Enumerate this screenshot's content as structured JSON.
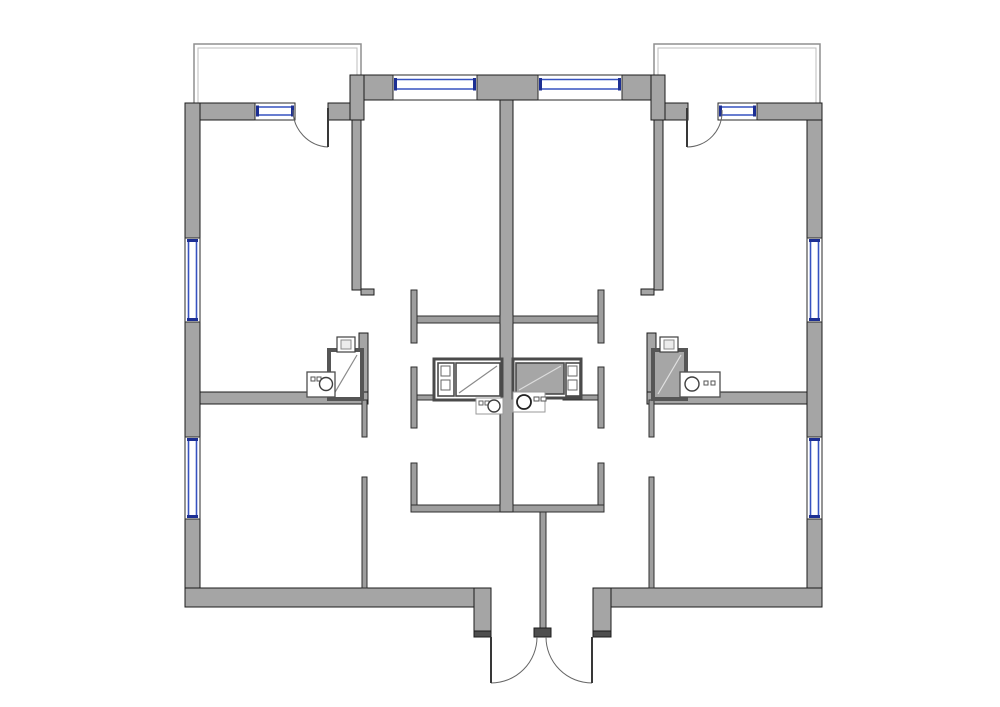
{
  "floorplan": {
    "canvas": {
      "width": 1000,
      "height": 707
    },
    "colors": {
      "bg": "#ffffff",
      "wall": "#a5a5a5",
      "thin": "#9e9e9e",
      "dark": "#4e4e4e",
      "outline": "#1c1c1c",
      "thin_outline": "#2f2f2f",
      "window_blue": "#3752c0",
      "window_navy": "#1d2f93",
      "window_frame": "#2a2a2a",
      "door_arc": "#666666",
      "door_leaf": "#383838",
      "balcony_outer": "#8f8f8f",
      "balcony_inner": "#bdbdbd"
    },
    "walls": [
      {
        "name": "exterior-wall-left-upper",
        "type": "wall",
        "x": 185,
        "y": 103,
        "w": 15,
        "h": 135
      },
      {
        "name": "exterior-wall-left-middle",
        "type": "wall",
        "x": 185,
        "y": 322,
        "w": 15,
        "h": 115
      },
      {
        "name": "exterior-wall-left-lower",
        "type": "wall",
        "x": 185,
        "y": 519,
        "w": 15,
        "h": 88
      },
      {
        "name": "exterior-wall-topleft-a",
        "type": "wall",
        "x": 200,
        "y": 103,
        "w": 55,
        "h": 17
      },
      {
        "name": "exterior-wall-topleft-b",
        "type": "wall",
        "x": 328,
        "y": 103,
        "w": 22,
        "h": 17
      },
      {
        "name": "exterior-wall-step-left",
        "type": "wall",
        "x": 350,
        "y": 75,
        "w": 14,
        "h": 45
      },
      {
        "name": "exterior-wall-pier-left",
        "type": "wall",
        "x": 364,
        "y": 75,
        "w": 29,
        "h": 25
      },
      {
        "name": "exterior-wall-pier-center",
        "type": "wall",
        "x": 477,
        "y": 75,
        "w": 61,
        "h": 25
      },
      {
        "name": "exterior-wall-pier-right",
        "type": "wall",
        "x": 622,
        "y": 75,
        "w": 29,
        "h": 25
      },
      {
        "name": "exterior-wall-step-right",
        "type": "wall",
        "x": 651,
        "y": 75,
        "w": 14,
        "h": 45
      },
      {
        "name": "exterior-wall-topright-a",
        "type": "wall",
        "x": 665,
        "y": 103,
        "w": 23,
        "h": 17
      },
      {
        "name": "exterior-wall-topright-b",
        "type": "wall",
        "x": 757,
        "y": 103,
        "w": 65,
        "h": 17
      },
      {
        "name": "exterior-wall-right-upper",
        "type": "wall",
        "x": 807,
        "y": 120,
        "w": 15,
        "h": 118
      },
      {
        "name": "exterior-wall-right-middle",
        "type": "wall",
        "x": 807,
        "y": 322,
        "w": 15,
        "h": 115
      },
      {
        "name": "exterior-wall-right-lower",
        "type": "wall",
        "x": 807,
        "y": 519,
        "w": 15,
        "h": 88
      },
      {
        "name": "exterior-wall-bottom-left",
        "type": "wall",
        "x": 185,
        "y": 588,
        "w": 289,
        "h": 19
      },
      {
        "name": "entry-jamb-left",
        "type": "wall",
        "x": 474,
        "y": 588,
        "w": 17,
        "h": 43
      },
      {
        "name": "exterior-wall-bottom-right",
        "type": "wall",
        "x": 611,
        "y": 588,
        "w": 211,
        "h": 19
      },
      {
        "name": "entry-jamb-right",
        "type": "wall",
        "x": 593,
        "y": 588,
        "w": 18,
        "h": 43
      },
      {
        "name": "party-wall-center",
        "type": "wall",
        "x": 500,
        "y": 100,
        "w": 13,
        "h": 412
      },
      {
        "name": "entry-divider-wall",
        "type": "thin",
        "x": 540,
        "y": 512,
        "w": 6,
        "h": 116
      },
      {
        "name": "bedroom-wall-left",
        "type": "wall",
        "x": 352,
        "y": 120,
        "w": 9,
        "h": 170
      },
      {
        "name": "bedroom-wall-left-foot",
        "type": "wall",
        "x": 361,
        "y": 289,
        "w": 13,
        "h": 6
      },
      {
        "name": "bedroom-wall-right",
        "type": "wall",
        "x": 654,
        "y": 120,
        "w": 9,
        "h": 170
      },
      {
        "name": "bedroom-wall-right-foot",
        "type": "wall",
        "x": 641,
        "y": 289,
        "w": 13,
        "h": 6
      },
      {
        "name": "room-divider-left",
        "type": "wall",
        "x": 200,
        "y": 392,
        "w": 168,
        "h": 12
      },
      {
        "name": "room-divider-right",
        "type": "wall",
        "x": 647,
        "y": 392,
        "w": 160,
        "h": 12
      },
      {
        "name": "bath-wall-left",
        "type": "wall",
        "x": 359,
        "y": 333,
        "w": 9,
        "h": 59
      },
      {
        "name": "bath-wall-right",
        "type": "wall",
        "x": 647,
        "y": 333,
        "w": 9,
        "h": 59
      },
      {
        "name": "kitchen-wall-left-cap",
        "type": "thin",
        "x": 411,
        "y": 290,
        "w": 6,
        "h": 53
      },
      {
        "name": "kitchen-wall-left-top",
        "type": "thin",
        "x": 417,
        "y": 316,
        "w": 83,
        "h": 7
      },
      {
        "name": "kitchen-wall-right-cap",
        "type": "thin",
        "x": 598,
        "y": 290,
        "w": 6,
        "h": 53
      },
      {
        "name": "kitchen-wall-right-top",
        "type": "thin",
        "x": 513,
        "y": 316,
        "w": 85,
        "h": 7
      },
      {
        "name": "kitchen-wall-left-mid",
        "type": "thin",
        "x": 411,
        "y": 367,
        "w": 6,
        "h": 61
      },
      {
        "name": "kitchen-wall-right-mid",
        "type": "thin",
        "x": 598,
        "y": 367,
        "w": 6,
        "h": 61
      },
      {
        "name": "kitchen-wall-left-low",
        "type": "thin",
        "x": 411,
        "y": 463,
        "w": 6,
        "h": 49
      },
      {
        "name": "kitchen-wall-left-bottom",
        "type": "thin",
        "x": 411,
        "y": 505,
        "w": 89,
        "h": 7
      },
      {
        "name": "kitchen-wall-right-low",
        "type": "thin",
        "x": 598,
        "y": 463,
        "w": 6,
        "h": 49
      },
      {
        "name": "kitchen-wall-right-bottom",
        "type": "thin",
        "x": 513,
        "y": 505,
        "w": 91,
        "h": 7
      },
      {
        "name": "hall-wall-left-upper",
        "type": "thin",
        "x": 362,
        "y": 400,
        "w": 5,
        "h": 37
      },
      {
        "name": "hall-wall-right-upper",
        "type": "thin",
        "x": 649,
        "y": 400,
        "w": 5,
        "h": 37
      },
      {
        "name": "hall-wall-left-lower",
        "type": "thin",
        "x": 362,
        "y": 477,
        "w": 5,
        "h": 111
      },
      {
        "name": "hall-wall-right-lower",
        "type": "thin",
        "x": 649,
        "y": 477,
        "w": 5,
        "h": 111
      },
      {
        "name": "appliance-wall-left",
        "type": "thin",
        "x": 417,
        "y": 395,
        "w": 35,
        "h": 5
      },
      {
        "name": "appliance-wall-right",
        "type": "thin",
        "x": 563,
        "y": 395,
        "w": 35,
        "h": 5
      },
      {
        "name": "entry-jamb-cap-left",
        "type": "dark",
        "x": 474,
        "y": 631,
        "w": 17,
        "h": 6
      },
      {
        "name": "entry-jamb-cap-right",
        "type": "dark",
        "x": 593,
        "y": 631,
        "w": 18,
        "h": 6
      },
      {
        "name": "entry-center-cap",
        "type": "dark",
        "x": 534,
        "y": 628,
        "w": 17,
        "h": 9
      }
    ],
    "windows": [
      {
        "name": "window-left-upper",
        "dir": "v",
        "x": 185,
        "y": 238,
        "w": 15,
        "h": 84,
        "o1": 3.5,
        "o2": 11.5
      },
      {
        "name": "window-left-lower",
        "dir": "v",
        "x": 185,
        "y": 437,
        "w": 15,
        "h": 82,
        "o1": 3.5,
        "o2": 11.5
      },
      {
        "name": "window-right-upper",
        "dir": "v",
        "x": 807,
        "y": 238,
        "w": 15,
        "h": 84,
        "o1": 3.5,
        "o2": 11.5
      },
      {
        "name": "window-right-lower",
        "dir": "v",
        "x": 807,
        "y": 437,
        "w": 15,
        "h": 82,
        "o1": 3.5,
        "o2": 11.5
      },
      {
        "name": "window-balcony-left",
        "dir": "h",
        "x": 255,
        "y": 103,
        "w": 40,
        "h": 17,
        "o1": 4,
        "o2": 12
      },
      {
        "name": "window-balcony-right",
        "dir": "h",
        "x": 718,
        "y": 103,
        "w": 39,
        "h": 17,
        "o1": 4,
        "o2": 12
      },
      {
        "name": "window-top-left",
        "dir": "h",
        "x": 393,
        "y": 75,
        "w": 84,
        "h": 25,
        "o1": 4.5,
        "o2": 14
      },
      {
        "name": "window-top-right",
        "dir": "h",
        "x": 538,
        "y": 75,
        "w": 84,
        "h": 25,
        "o1": 4.5,
        "o2": 14
      }
    ],
    "balconies": [
      {
        "name": "balcony-left",
        "outer": "M194,104 L194,44 L361,44 L361,104",
        "inner": "M198,104 L198,48 L357,48 L357,104"
      },
      {
        "name": "balcony-right",
        "outer": "M654,104 L654,44 L820,44 L820,104",
        "inner": "M658,104 L658,48 L816,48 L816,104"
      }
    ],
    "doors": [
      {
        "name": "balcony-door-left",
        "leaf": [
          328,
          108,
          328,
          147
        ],
        "arc": "M293,110 A37,37 0 0 0 328,147"
      },
      {
        "name": "balcony-door-right",
        "leaf": [
          687,
          108,
          687,
          147
        ],
        "arc": "M722,110 A35,35 0 0 1 687,147"
      },
      {
        "name": "entry-door-left",
        "leaf": [
          491,
          637,
          491,
          683
        ],
        "arc": "M537,637 A46,46 0 0 1 491,683"
      },
      {
        "name": "entry-door-right",
        "leaf": [
          592,
          637,
          592,
          683
        ],
        "arc": "M546,637 A46,46 0 0 0 592,683"
      }
    ],
    "fixtures": [
      {
        "name": "bathtub-left-corner",
        "shapes": [
          {
            "t": "rect",
            "x": 329,
            "y": 350,
            "w": 33,
            "h": 49,
            "f": "#ffffff",
            "s": "#565656",
            "sw": 4
          },
          {
            "t": "line",
            "x1": 334,
            "y1": 394,
            "x2": 357,
            "y2": 355,
            "s": "#8a8a8a",
            "sw": 1.2
          }
        ]
      },
      {
        "name": "toilet-left",
        "shapes": [
          {
            "t": "rect",
            "x": 337,
            "y": 337,
            "w": 18,
            "h": 15,
            "f": "#ffffff",
            "s": "#3f3f3f",
            "sw": 1.2
          },
          {
            "t": "rect",
            "x": 341,
            "y": 340,
            "w": 10,
            "h": 9,
            "f": "#ececec",
            "s": "#8a8a8a",
            "sw": 1
          }
        ]
      },
      {
        "name": "sink-left-corner",
        "shapes": [
          {
            "t": "rect",
            "x": 307,
            "y": 372,
            "w": 28,
            "h": 25,
            "f": "#ffffff",
            "s": "#4f4f4f",
            "sw": 1.3
          },
          {
            "t": "rect",
            "x": 311,
            "y": 377,
            "w": 4,
            "h": 4,
            "f": "#ffffff",
            "s": "#555555",
            "sw": 1
          },
          {
            "t": "rect",
            "x": 317,
            "y": 377,
            "w": 4,
            "h": 4,
            "f": "#ffffff",
            "s": "#555555",
            "sw": 1
          },
          {
            "t": "circle",
            "cx": 326,
            "cy": 384,
            "r": 6.5,
            "f": "#ffffff",
            "s": "#3f3f3f",
            "sw": 1.4
          }
        ]
      },
      {
        "name": "bath-unit-left-center",
        "shapes": [
          {
            "t": "rect",
            "x": 434,
            "y": 359,
            "w": 68,
            "h": 41,
            "f": "#ffffff",
            "s": "#4a4a4a",
            "sw": 3
          },
          {
            "t": "rect",
            "x": 438,
            "y": 363,
            "w": 16,
            "h": 33,
            "f": "#ffffff",
            "s": "#4a4a4a",
            "sw": 1.6
          },
          {
            "t": "rect",
            "x": 441,
            "y": 366,
            "w": 9,
            "h": 10,
            "f": "#ffffff",
            "s": "#666666",
            "sw": 1
          },
          {
            "t": "rect",
            "x": 441,
            "y": 380,
            "w": 9,
            "h": 10,
            "f": "#ffffff",
            "s": "#666666",
            "sw": 1
          },
          {
            "t": "rect",
            "x": 456,
            "y": 363,
            "w": 44,
            "h": 33,
            "f": "#ffffff",
            "s": "#4a4a4a",
            "sw": 1.6
          },
          {
            "t": "line",
            "x1": 459,
            "y1": 393,
            "x2": 497,
            "y2": 366,
            "s": "#8a8a8a",
            "sw": 1.2
          }
        ]
      },
      {
        "name": "kitchen-sink-left",
        "shapes": [
          {
            "t": "rect",
            "x": 476,
            "y": 398,
            "w": 27,
            "h": 16,
            "f": "#ffffff",
            "s": "#9a9a9a",
            "sw": 1
          },
          {
            "t": "rect",
            "x": 479,
            "y": 401,
            "w": 4,
            "h": 4,
            "f": "#ffffff",
            "s": "#666666",
            "sw": 1
          },
          {
            "t": "rect",
            "x": 485,
            "y": 401,
            "w": 4,
            "h": 4,
            "f": "#ffffff",
            "s": "#666666",
            "sw": 1
          },
          {
            "t": "circle",
            "cx": 494,
            "cy": 406,
            "r": 6,
            "f": "#ffffff",
            "s": "#3f3f3f",
            "sw": 1.4
          }
        ]
      },
      {
        "name": "bathtub-right-corner",
        "shapes": [
          {
            "t": "rect",
            "x": 653,
            "y": 350,
            "w": 33,
            "h": 49,
            "f": "#a6a6a6",
            "s": "#565656",
            "sw": 4
          },
          {
            "t": "line",
            "x1": 658,
            "y1": 394,
            "x2": 681,
            "y2": 355,
            "s": "#e0e0e0",
            "sw": 1.2
          }
        ]
      },
      {
        "name": "toilet-right",
        "shapes": [
          {
            "t": "rect",
            "x": 660,
            "y": 337,
            "w": 18,
            "h": 15,
            "f": "#ffffff",
            "s": "#3f3f3f",
            "sw": 1.2
          },
          {
            "t": "rect",
            "x": 664,
            "y": 340,
            "w": 10,
            "h": 9,
            "f": "#ececec",
            "s": "#8a8a8a",
            "sw": 1
          }
        ]
      },
      {
        "name": "sink-right-corner",
        "shapes": [
          {
            "t": "rect",
            "x": 680,
            "y": 372,
            "w": 40,
            "h": 25,
            "f": "#ffffff",
            "s": "#4f4f4f",
            "sw": 1.3
          },
          {
            "t": "circle",
            "cx": 692,
            "cy": 384,
            "r": 7,
            "f": "#ffffff",
            "s": "#3f3f3f",
            "sw": 1.4
          },
          {
            "t": "rect",
            "x": 704,
            "y": 381,
            "w": 4,
            "h": 4,
            "f": "#ffffff",
            "s": "#555555",
            "sw": 1
          },
          {
            "t": "rect",
            "x": 711,
            "y": 381,
            "w": 4,
            "h": 4,
            "f": "#ffffff",
            "s": "#555555",
            "sw": 1
          }
        ]
      },
      {
        "name": "bath-unit-right-center",
        "shapes": [
          {
            "t": "rect",
            "x": 513,
            "y": 359,
            "w": 68,
            "h": 39,
            "f": "#ffffff",
            "s": "#4a4a4a",
            "sw": 3
          },
          {
            "t": "rect",
            "x": 516,
            "y": 363,
            "w": 48,
            "h": 31,
            "f": "#a6a6a6",
            "s": "#4a4a4a",
            "sw": 1.6
          },
          {
            "t": "line",
            "x1": 519,
            "y1": 390,
            "x2": 561,
            "y2": 366,
            "s": "#dcdcdc",
            "sw": 1.2
          },
          {
            "t": "rect",
            "x": 566,
            "y": 363,
            "w": 14,
            "h": 33,
            "f": "#ffffff",
            "s": "#4a4a4a",
            "sw": 1.6
          },
          {
            "t": "rect",
            "x": 568,
            "y": 366,
            "w": 9,
            "h": 10,
            "f": "#ffffff",
            "s": "#666666",
            "sw": 1
          },
          {
            "t": "rect",
            "x": 568,
            "y": 380,
            "w": 9,
            "h": 10,
            "f": "#ffffff",
            "s": "#666666",
            "sw": 1
          }
        ]
      },
      {
        "name": "kitchen-sink-right",
        "shapes": [
          {
            "t": "rect",
            "x": 513,
            "y": 392,
            "w": 32,
            "h": 20,
            "f": "#ffffff",
            "s": "#9a9a9a",
            "sw": 1
          },
          {
            "t": "circle",
            "cx": 524,
            "cy": 402,
            "r": 7,
            "f": "#ffffff",
            "s": "#222222",
            "sw": 1.8
          },
          {
            "t": "rect",
            "x": 534,
            "y": 397,
            "w": 5,
            "h": 4,
            "f": "#ffffff",
            "s": "#555555",
            "sw": 1
          },
          {
            "t": "rect",
            "x": 541,
            "y": 397,
            "w": 5,
            "h": 4,
            "f": "#ffffff",
            "s": "#555555",
            "sw": 1
          }
        ]
      }
    ]
  }
}
